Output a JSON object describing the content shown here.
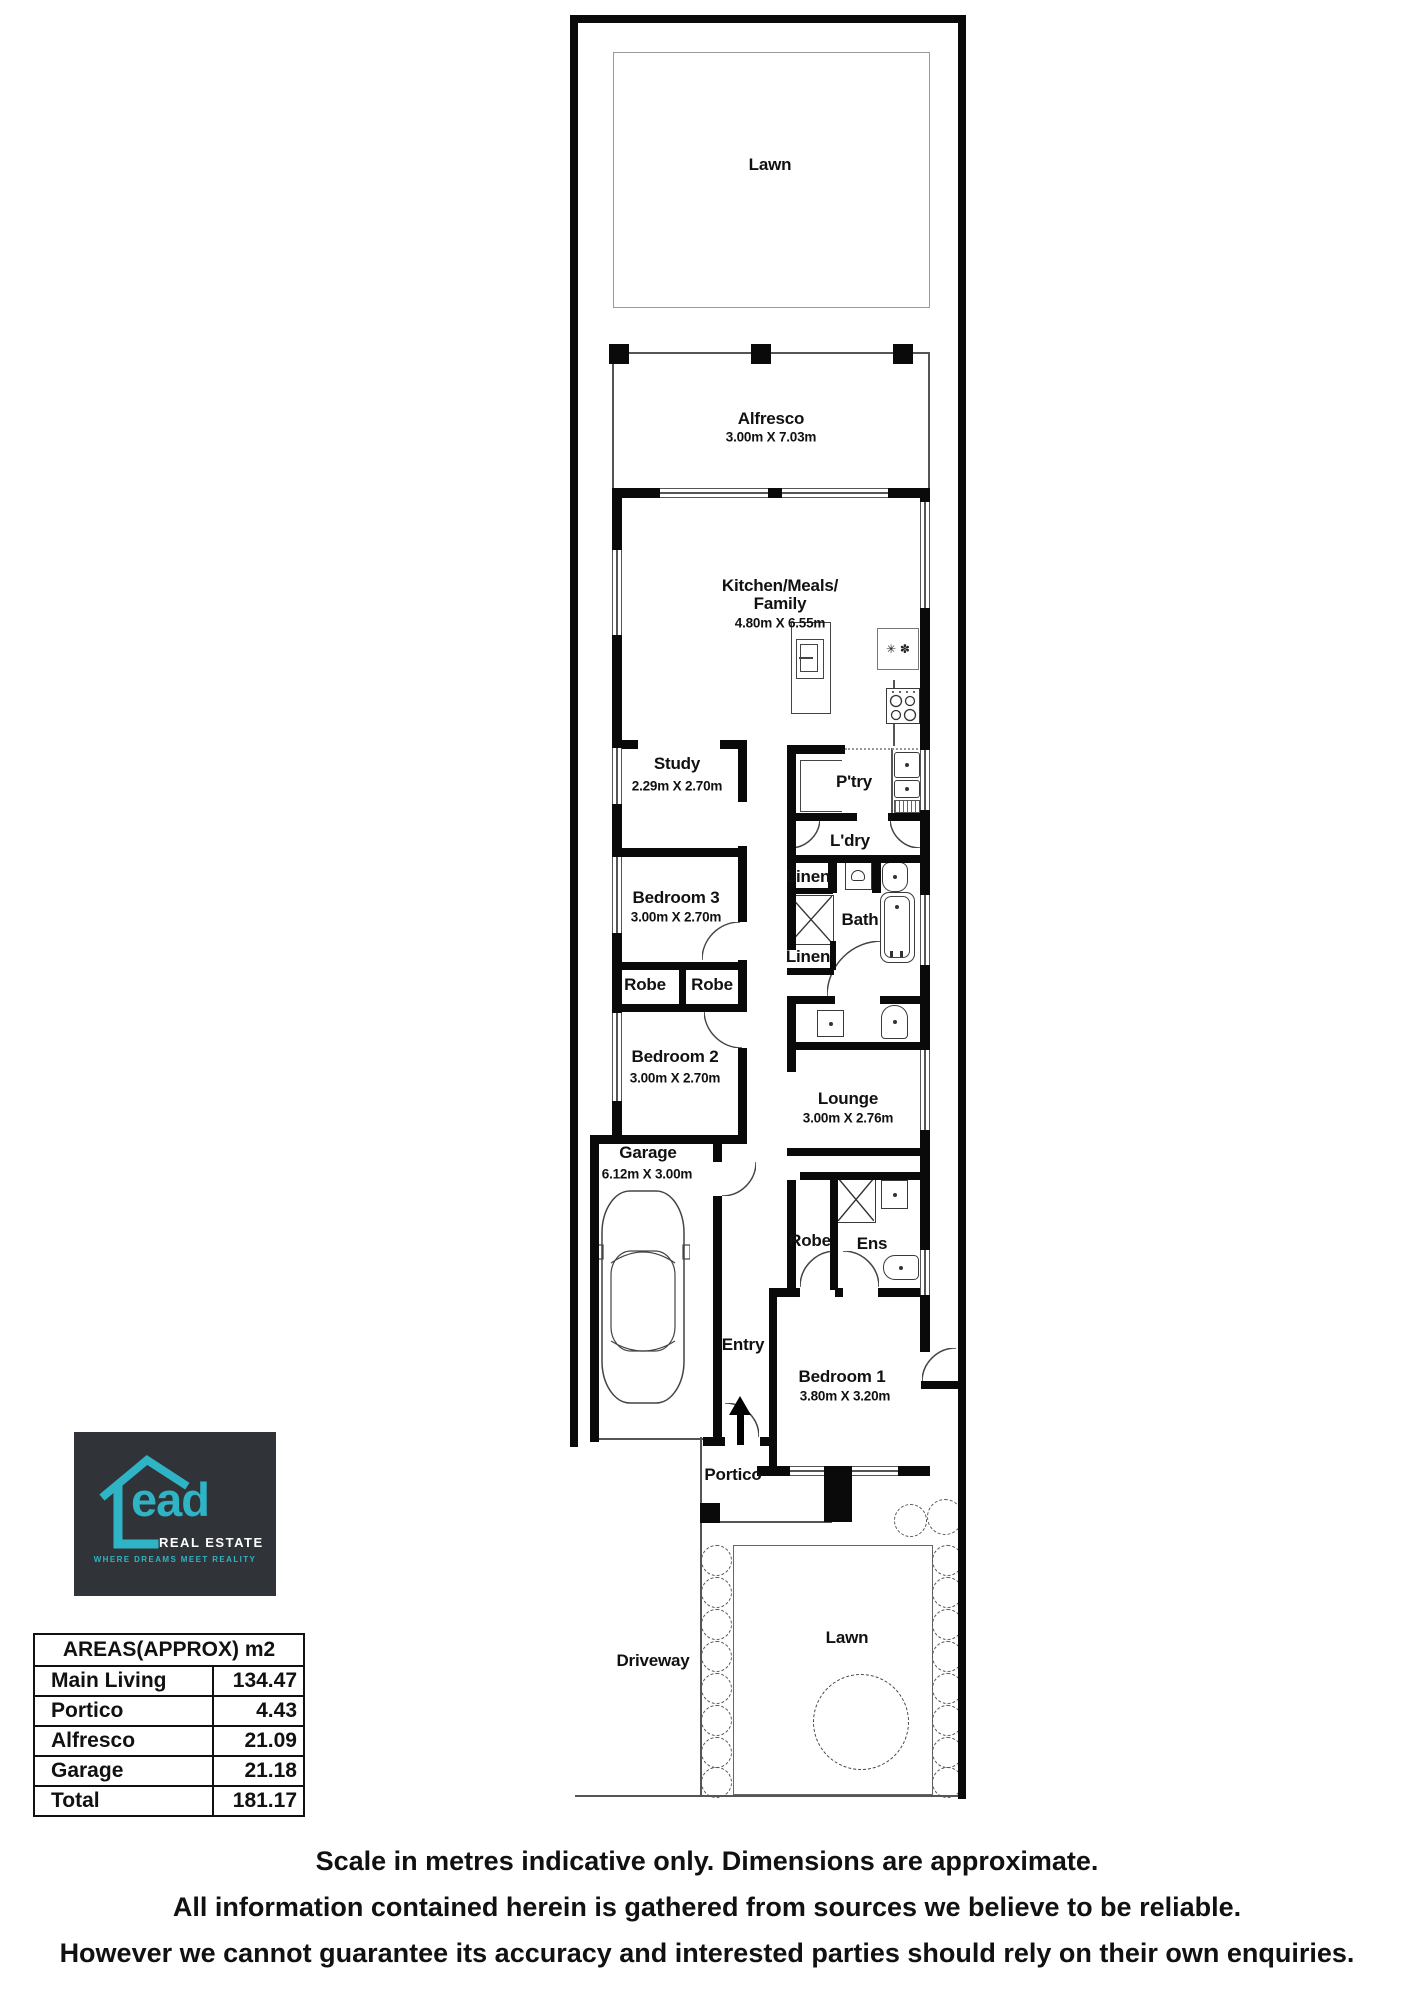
{
  "floorplan": {
    "lawn_top": {
      "label": "Lawn"
    },
    "alfresco": {
      "label": "Alfresco",
      "dims": "3.00m X 7.03m"
    },
    "kitchen": {
      "label_line1": "Kitchen/Meals/",
      "label_line2": "Family",
      "dims": "4.80m X 6.55m"
    },
    "study": {
      "label": "Study",
      "dims": "2.29m X 2.70m"
    },
    "pantry": {
      "label": "P'try"
    },
    "laundry": {
      "label": "L'dry"
    },
    "linen_top": {
      "label": "Linen"
    },
    "bath": {
      "label": "Bath"
    },
    "linen_bottom": {
      "label": "Linen"
    },
    "bedroom3": {
      "label": "Bedroom 3",
      "dims": "3.00m X 2.70m"
    },
    "robe_a": {
      "label": "Robe"
    },
    "robe_b": {
      "label": "Robe"
    },
    "bedroom2": {
      "label": "Bedroom 2",
      "dims": "3.00m X 2.70m"
    },
    "lounge": {
      "label": "Lounge",
      "dims": "3.00m X 2.76m"
    },
    "garage": {
      "label": "Garage",
      "dims": "6.12m X 3.00m"
    },
    "robe_bed1": {
      "label": "Robe"
    },
    "ensuite": {
      "label": "Ens"
    },
    "entry": {
      "label": "Entry"
    },
    "bedroom1": {
      "label": "Bedroom 1",
      "dims": "3.80m X 3.20m"
    },
    "portico": {
      "label": "Portico"
    },
    "driveway": {
      "label": "Driveway"
    },
    "lawn_bottom": {
      "label": "Lawn"
    },
    "icons": {
      "fridge_glyphs": "✳ ✽"
    }
  },
  "logo": {
    "brand_word": "ead",
    "brand_sub": "REAL ESTATE",
    "tagline": "WHERE DREAMS MEET REALITY",
    "colors": {
      "background": "#303338",
      "teal": "#2fb4c5",
      "text": "#ffffff"
    }
  },
  "areas_table": {
    "header": "AREAS(APPROX) m2",
    "rows": [
      {
        "label": "Main Living",
        "value": "134.47"
      },
      {
        "label": "Portico",
        "value": "4.43"
      },
      {
        "label": "Alfresco",
        "value": "21.09"
      },
      {
        "label": "Garage",
        "value": "21.18"
      },
      {
        "label": "Total",
        "value": "181.17"
      }
    ]
  },
  "disclaimer": {
    "line1": "Scale in metres indicative only. Dimensions are approximate.",
    "line2": "All information contained herein is gathered from sources we believe to be reliable.",
    "line3": "However we cannot guarantee its accuracy and interested parties should rely on their own enquiries."
  }
}
